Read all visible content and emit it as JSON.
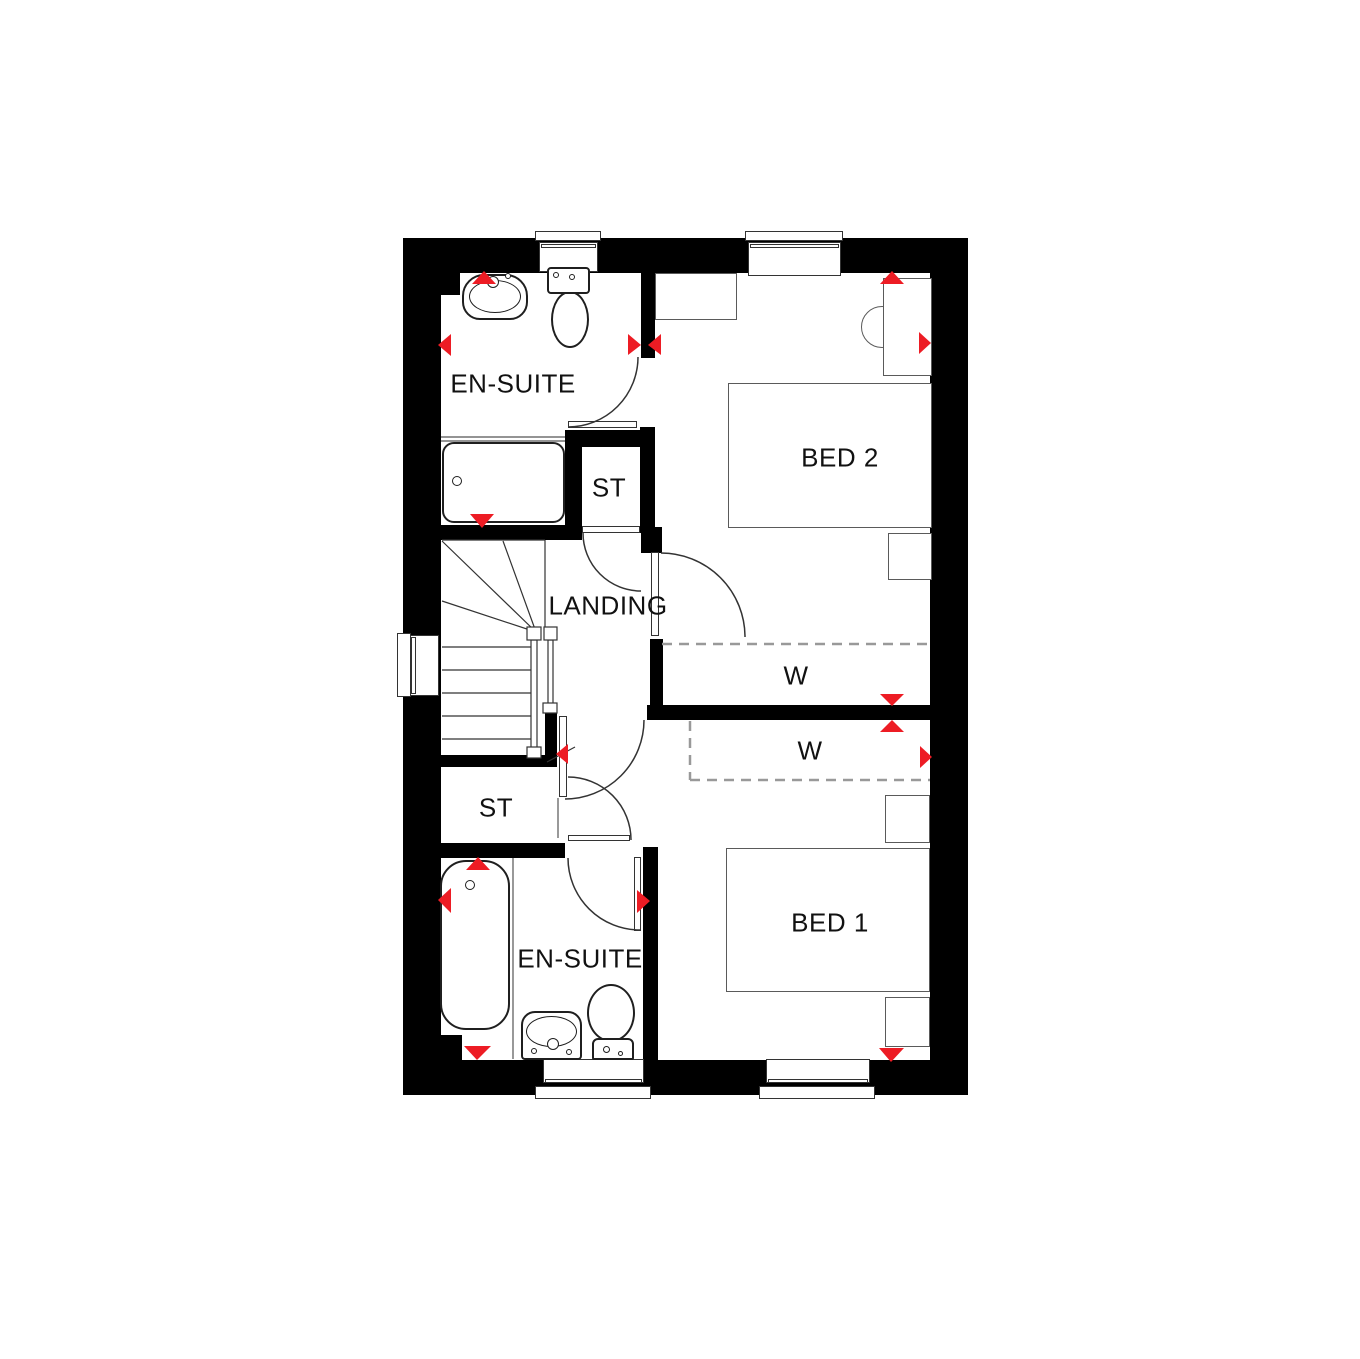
{
  "plan": {
    "type": "floor-plan",
    "rooms": {
      "ensuite_top": {
        "label": "EN-SUITE"
      },
      "st_top": {
        "label": "ST"
      },
      "landing": {
        "label": "LANDING"
      },
      "bed2": {
        "label": "BED 2"
      },
      "wardrobe_bed2": {
        "label": "W"
      },
      "wardrobe_bed1": {
        "label": "W"
      },
      "st_bottom": {
        "label": "ST"
      },
      "ensuite_bottom": {
        "label": "EN-SUITE"
      },
      "bed1": {
        "label": "BED 1"
      }
    },
    "colors": {
      "wall": "#000000",
      "background": "#ffffff",
      "fixture_line": "#1f1f1f",
      "furniture_line": "#5a5a5a",
      "door_line": "#333333",
      "arrow_red": "#ed1c24",
      "dashed_line": "#999999"
    },
    "fixtures": [
      "basin",
      "toilet",
      "shower-tray",
      "bath",
      "stairs",
      "bed",
      "bedside-table",
      "desk",
      "chair",
      "shelf",
      "wardrobe",
      "window",
      "door"
    ]
  }
}
